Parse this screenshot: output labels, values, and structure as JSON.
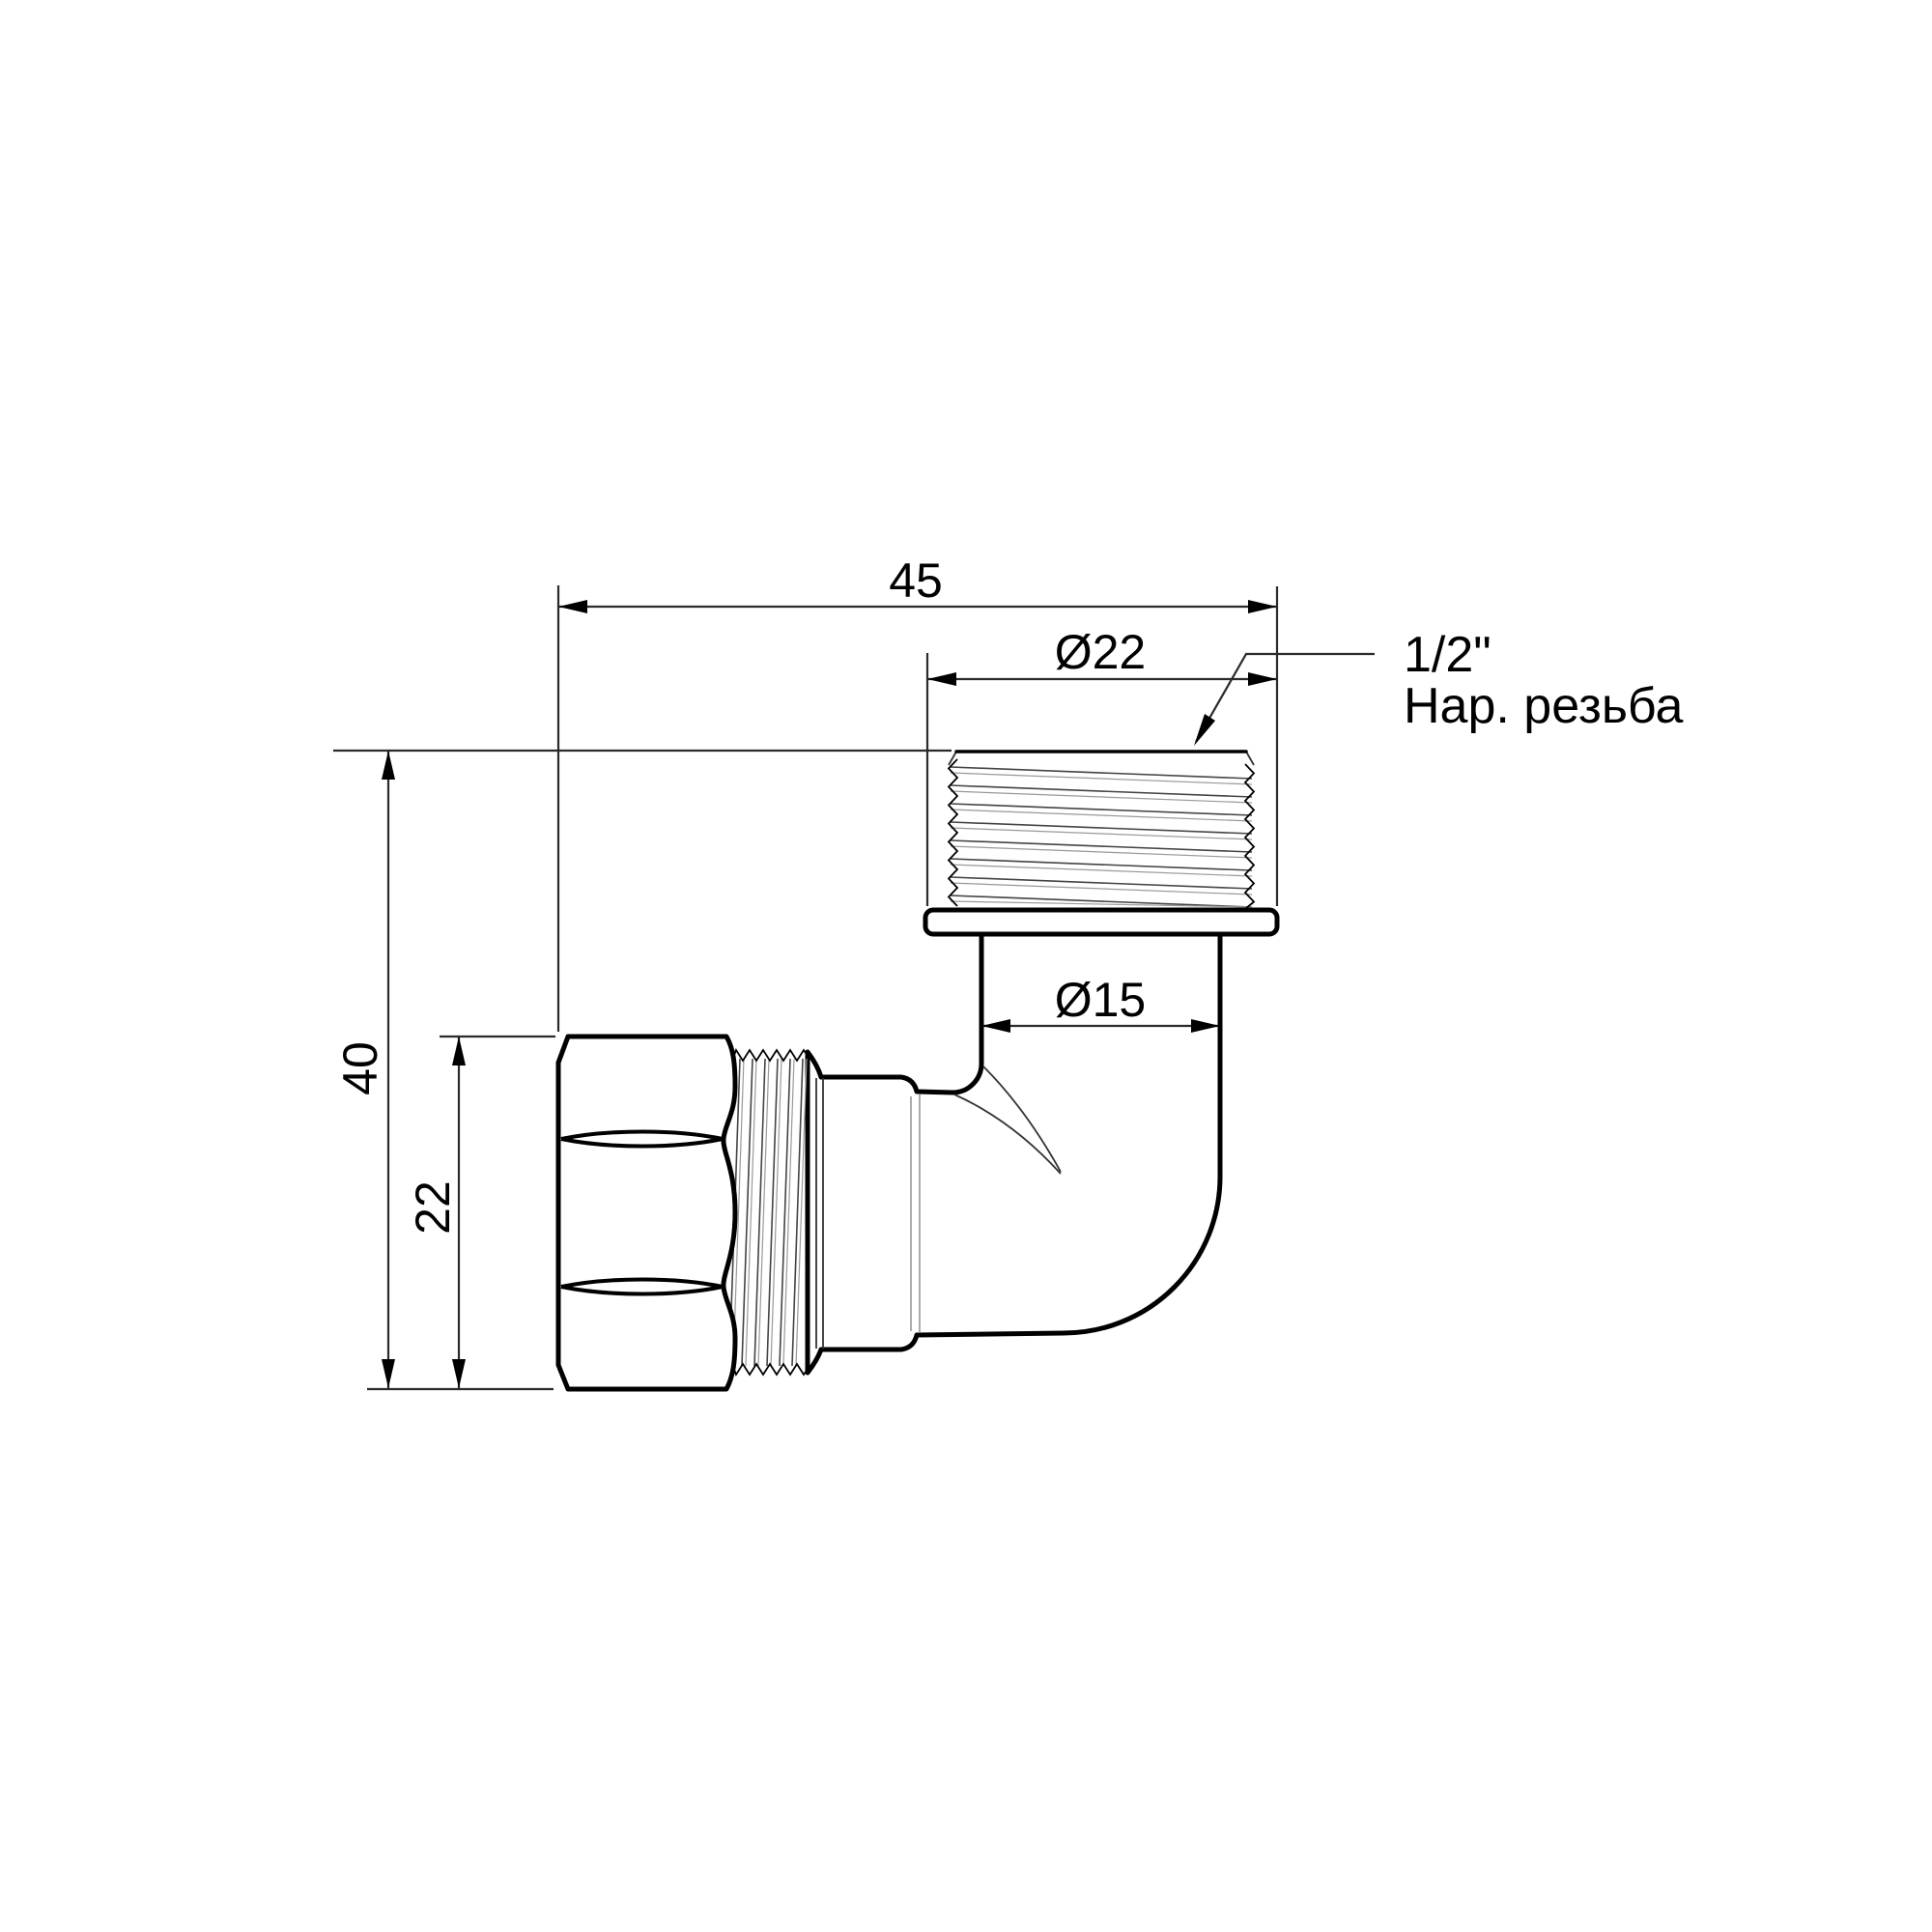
{
  "drawing": {
    "dimensions": {
      "overall_width": "45",
      "thread_diameter": "Ø22",
      "pipe_diameter": "Ø15",
      "overall_height": "40",
      "hex_size": "22"
    },
    "note": {
      "line1": "1/2\"",
      "line2": "Нар. резьба"
    },
    "colors": {
      "line": "#000000",
      "background": "#ffffff"
    }
  }
}
